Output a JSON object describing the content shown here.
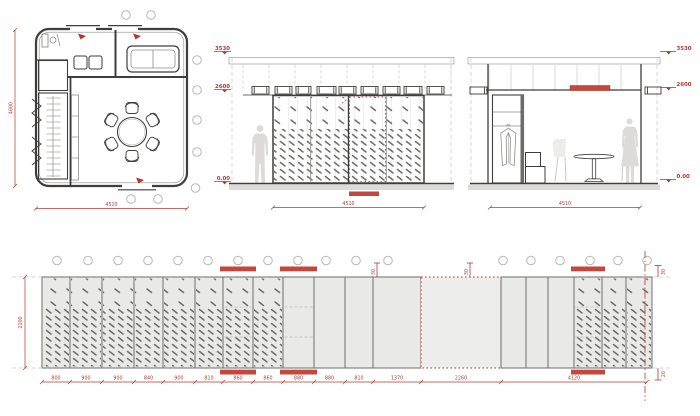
{
  "colors": {
    "red": "#b43a2f",
    "red_fill": "#c4473d",
    "dark": "#3f3e3c",
    "mid": "#8f8e8c",
    "light": "#c8c7c5",
    "panel_fill": "#e9e9e7",
    "dotted_fill": "#ededeb",
    "speckle": "#6e6e6c",
    "silhouette": "#dcdbd9"
  },
  "plan": {
    "dim_left": "4600",
    "dim_bottom": "4510",
    "bubbles": [
      [
        126,
        15
      ],
      [
        151,
        15
      ],
      [
        197,
        60
      ],
      [
        197,
        90
      ],
      [
        197,
        120
      ],
      [
        197,
        152
      ],
      [
        195.5,
        188
      ],
      [
        131,
        199
      ],
      [
        158,
        199
      ]
    ]
  },
  "elevation_a": {
    "level_top": "3530",
    "level_mid": "2600",
    "level_floor": "0.00",
    "dim_bottom": "4510"
  },
  "elevation_b": {
    "level_top": "3530",
    "level_mid": "2600",
    "level_floor": "0.00",
    "dim_bottom": "4510"
  },
  "long_elevation": {
    "dim_left": "2100",
    "x0": 42,
    "panels": [
      {
        "w": 28,
        "t": "s"
      },
      {
        "w": 32,
        "t": "s"
      },
      {
        "w": 32,
        "t": "s"
      },
      {
        "w": 29,
        "t": "s"
      },
      {
        "w": 32,
        "t": "s"
      },
      {
        "w": 28,
        "t": "s"
      },
      {
        "w": 30,
        "t": "sd",
        "bar": true
      },
      {
        "w": 30,
        "t": "s"
      },
      {
        "w": 31,
        "t": "pd",
        "bar": true
      },
      {
        "w": 31,
        "t": "p"
      },
      {
        "w": 28,
        "t": "p"
      },
      {
        "w": 48,
        "t": "p"
      },
      {
        "w": 80,
        "t": "dot"
      },
      {
        "w": 25,
        "t": "p"
      },
      {
        "w": 22,
        "t": "p"
      },
      {
        "w": 26,
        "t": "p"
      },
      {
        "w": 28,
        "t": "sd",
        "bar": true
      },
      {
        "w": 24,
        "t": "s"
      },
      {
        "w": 26,
        "t": "s"
      }
    ],
    "dims": [
      {
        "v": "800",
        "w": 28
      },
      {
        "v": "900",
        "w": 32
      },
      {
        "v": "900",
        "w": 32
      },
      {
        "v": "840",
        "w": 29
      },
      {
        "v": "900",
        "w": 32
      },
      {
        "v": "810",
        "w": 28
      },
      {
        "v": "860",
        "w": 30
      },
      {
        "v": "860",
        "w": 30
      },
      {
        "v": "880",
        "w": 31
      },
      {
        "v": "880",
        "w": 31
      },
      {
        "v": "810",
        "w": 28
      },
      {
        "v": "1370",
        "w": 48
      },
      {
        "v": "2260",
        "w": 80
      },
      {
        "v": "4120",
        "w": 146
      }
    ],
    "bubbles_x": [
      57,
      88,
      118,
      148,
      178,
      208,
      238,
      268,
      298,
      326,
      356,
      388,
      503,
      531,
      560,
      590,
      618,
      647
    ],
    "gap_markers": [
      {
        "x": 377,
        "value": "30"
      },
      {
        "x": 470,
        "value": "30"
      }
    ],
    "right_top": "30",
    "right_bottom": "20"
  }
}
